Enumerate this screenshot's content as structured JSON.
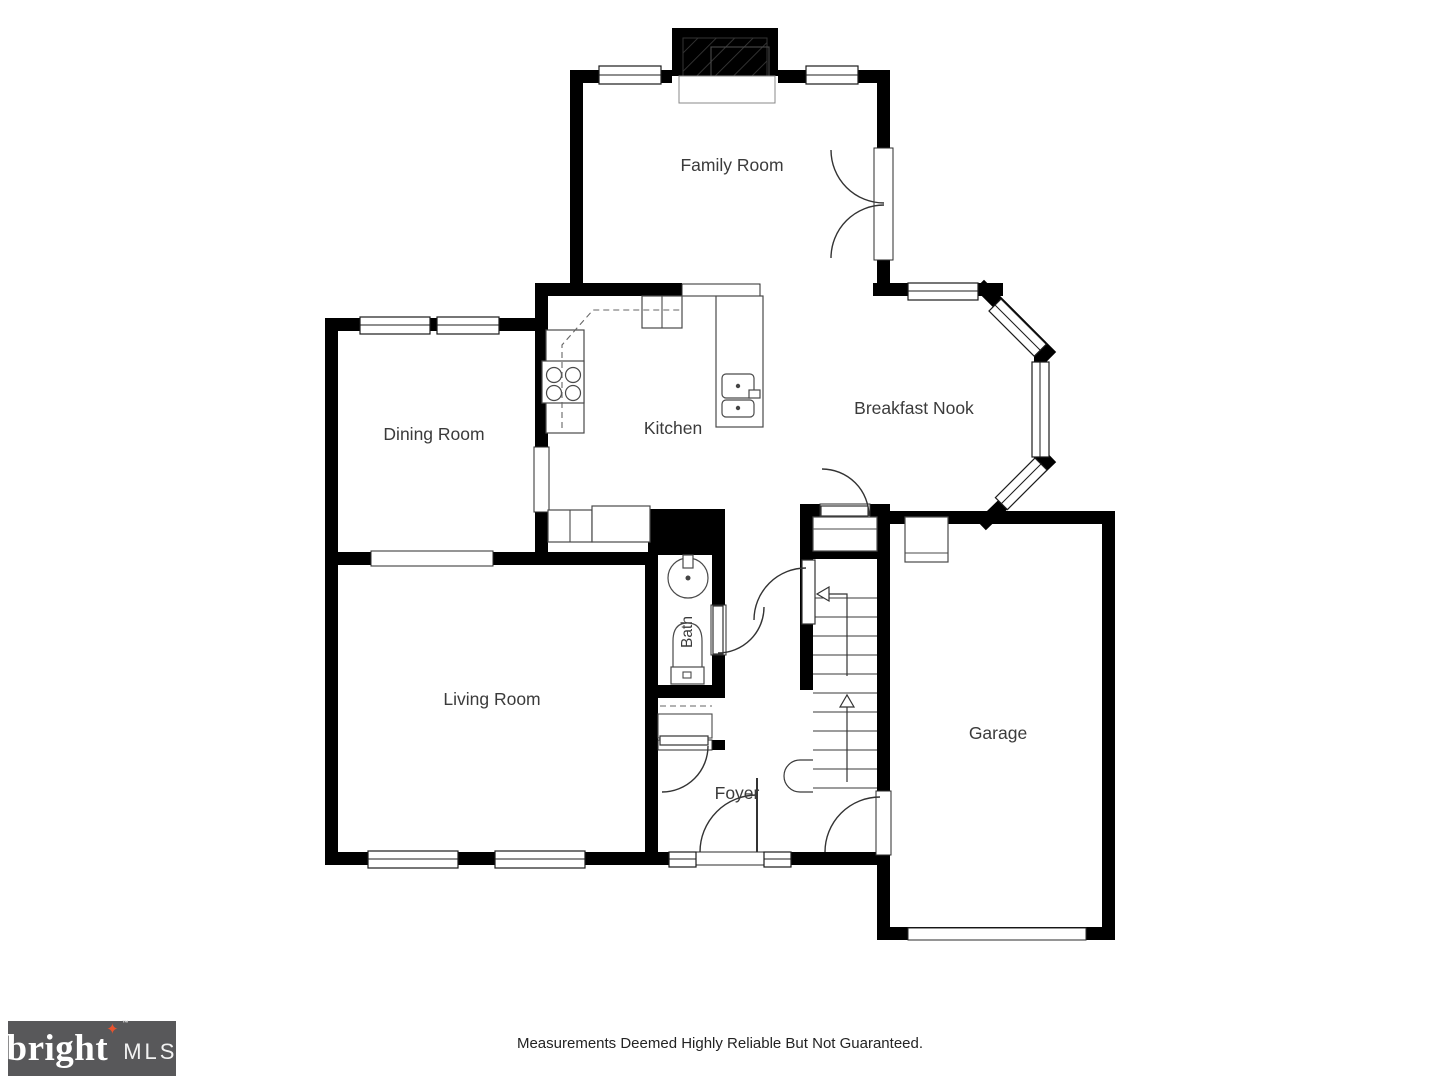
{
  "floorplan": {
    "rooms": {
      "family_room": "Family Room",
      "dining_room": "Dining Room",
      "kitchen": "Kitchen",
      "breakfast_nook": "Breakfast Nook",
      "bath": "Bath",
      "living_room": "Living Room",
      "foyer": "Foyer",
      "garage": "Garage"
    },
    "colors": {
      "wall": "#000000",
      "label": "#3b3b3b"
    }
  },
  "footer": {
    "disclaimer": "Measurements Deemed Highly Reliable But Not Guaranteed."
  },
  "logo": {
    "brand": "bright",
    "star": "✦",
    "tm": "™",
    "suffix": "MLS",
    "colors": {
      "background": "#58585a",
      "star": "#e8532e"
    }
  }
}
